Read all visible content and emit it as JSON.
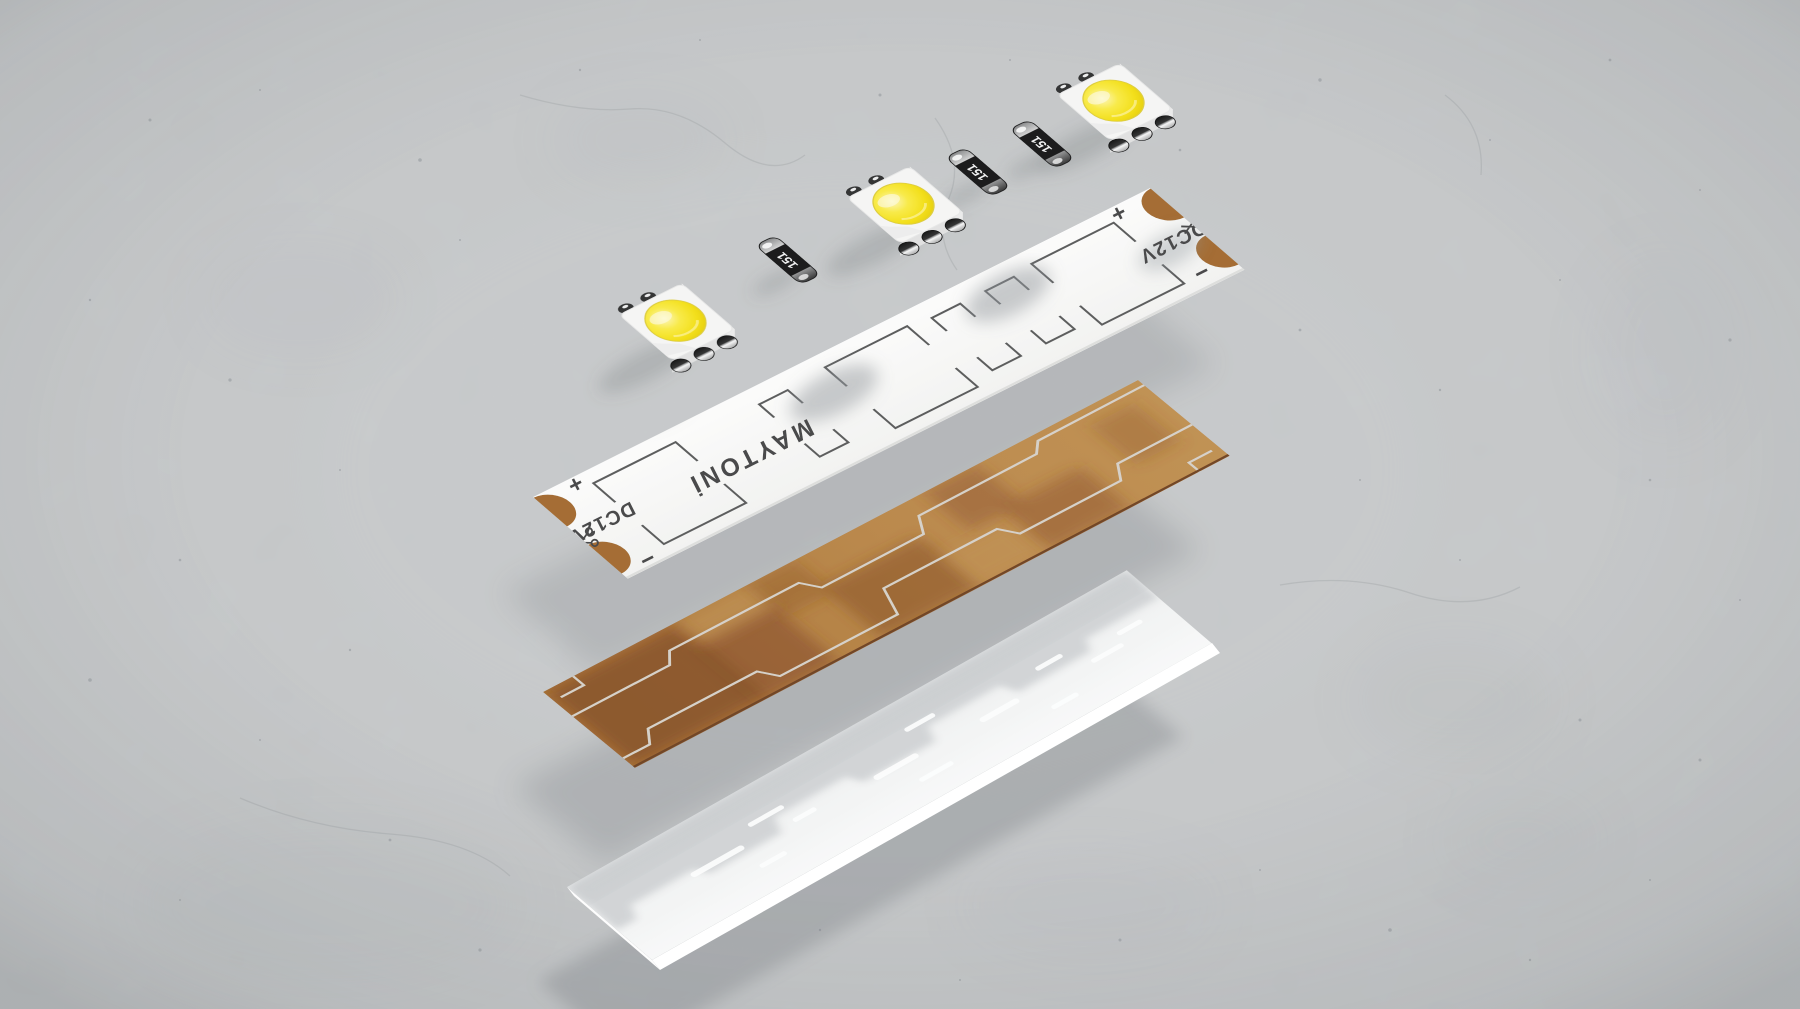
{
  "scene": {
    "description": "Exploded 3D render of an LED strip on a concrete surface",
    "layers": [
      "led-chips",
      "resistors",
      "printed-pcb",
      "copper-foil",
      "adhesive-backing"
    ]
  },
  "brand": {
    "logo": "MAYTONİ"
  },
  "pcb": {
    "voltage_label": "DC12V",
    "polarity_plus": "+",
    "polarity_minus": "−",
    "cut_mark_icon": "scissors-icon",
    "solder_pads_per_end": 2
  },
  "components": {
    "led_count": 3,
    "resistor_count": 3,
    "resistor_label": "151"
  },
  "colors": {
    "concrete": "#b6b8b9",
    "pcb_white": "#f7f7f6",
    "copper_foil": "#a9713f",
    "copper_shadowed": "#6a4123",
    "solder_pad": "#8d5a2b",
    "led_dome_yellow": "#f2d716",
    "backing_white": "#eef0f0",
    "silkscreen": "#3d3d3d"
  }
}
